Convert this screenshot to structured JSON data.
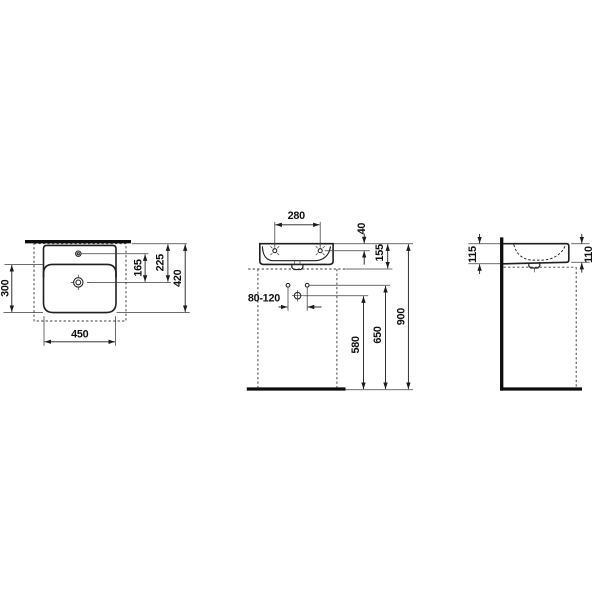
{
  "colors": {
    "background": "#ffffff",
    "object_line": "#1f1f1f",
    "thick_line": "#0d0d0d",
    "text": "#111111"
  },
  "dimensions": {
    "top_view": {
      "d450": "450",
      "d300": "300",
      "d165": "165",
      "d225": "225",
      "d420": "420"
    },
    "front_view": {
      "d280": "280",
      "d40": "40",
      "d155": "155",
      "d80_120": "80-120",
      "d580": "580",
      "d650": "650",
      "d900": "900"
    },
    "side_view": {
      "d115": "115",
      "d110": "110"
    }
  }
}
